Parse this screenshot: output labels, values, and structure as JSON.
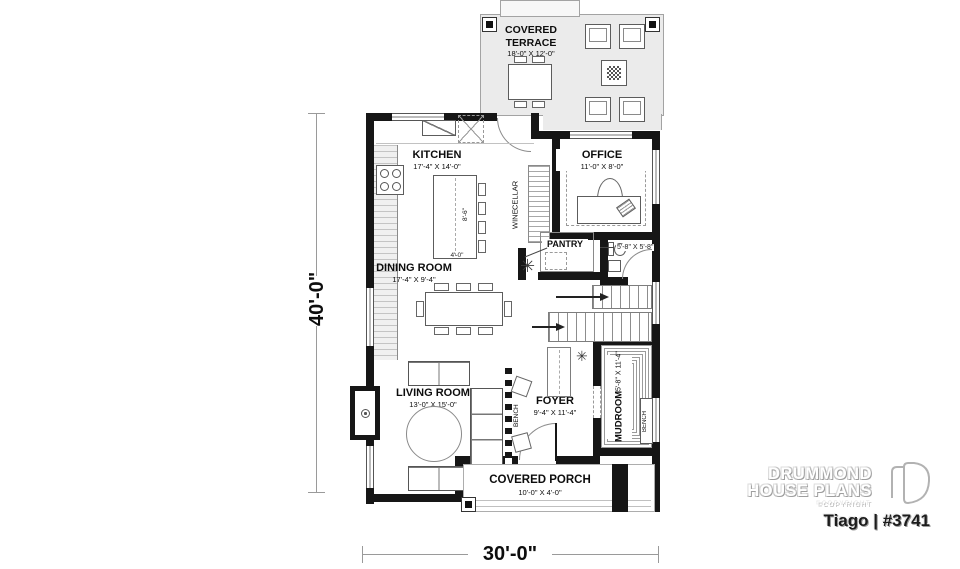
{
  "dimensions": {
    "overall_width": "30'-0\"",
    "overall_depth": "40'-0\"",
    "island_length": "8'-6\"",
    "island_width": "4'-0\"",
    "powder_room": "5'-8\" X 5'-8\""
  },
  "rooms": {
    "terrace": {
      "line1": "COVERED",
      "line2": "TERRACE",
      "dims": "18'-0\" X 12'-0\""
    },
    "kitchen": {
      "name": "KITCHEN",
      "dims": "17'-4\" X 14'-0\""
    },
    "office": {
      "name": "OFFICE",
      "dims": "11'-0\" X 8'-0\""
    },
    "wine_cellar": {
      "line1": "WINE",
      "line2": "CELLAR"
    },
    "pantry": {
      "name": "PANTRY"
    },
    "dining": {
      "name": "DINING ROOM",
      "dims": "17'-4\" X 9'-4\""
    },
    "living": {
      "name": "LIVING ROOM",
      "dims": "13'-0\" X 15'-0\""
    },
    "foyer": {
      "name": "FOYER",
      "dims": "9'-4\" X 11'-4\""
    },
    "mudroom": {
      "name": "MUDROOM",
      "dims": "5'-8\" X 11'-4\""
    },
    "porch": {
      "name": "COVERED PORCH",
      "dims": "10'-0\" X 4'-0\""
    },
    "bench_living": "BENCH",
    "bench_mudroom": "BENCH"
  },
  "branding": {
    "logo_line1": "DRUMMOND",
    "logo_line2": "HOUSE PLANS",
    "copyright": "©COPYRIGHT",
    "plan_name": "Tiago | #3741"
  }
}
